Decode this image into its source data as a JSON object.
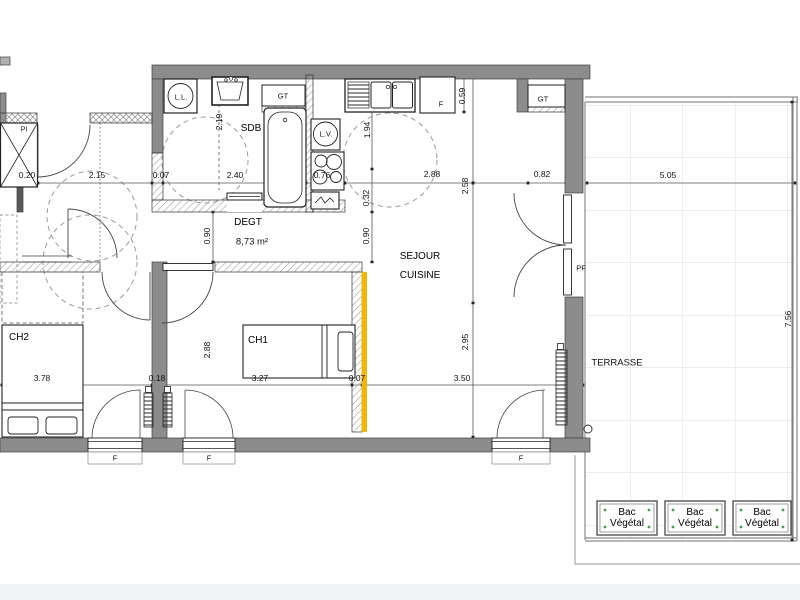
{
  "colors": {
    "wall_gray": "#8C8C8C",
    "highlight_wall": "#F2B705",
    "terrace_grid": "#DCDCDC",
    "planter_dot_green": "#3FA33F"
  },
  "rooms": {
    "sdb": "SDB",
    "degt": "DEGT",
    "degt_area": "8,73 m²",
    "sejour_line1": "SEJOUR",
    "sejour_line2": "CUISINE",
    "ch1": "CH1",
    "ch2": "CH2",
    "terrasse": "TERRASSE"
  },
  "fixtures": {
    "washing_machine": "L.L.",
    "dishwasher": "L.V.",
    "duct_bath": "GT",
    "duct_kitchen": "GT",
    "fridge": "F",
    "closet": "PI",
    "french_window": "PF"
  },
  "windows": {
    "f1": "F",
    "f2": "F",
    "f3": "F"
  },
  "planter": {
    "line1": "Bac",
    "line2": "Végétal"
  },
  "dimensions": {
    "top_chain": {
      "d1": "0.20",
      "d2": "2.15",
      "d3": "0.07",
      "d4": "2.40",
      "d5": "0.76",
      "d6": "2.88",
      "d7": "0.82"
    },
    "bottom_chain": {
      "d1": "3.78",
      "d2": "0.18",
      "d3": "3.27",
      "d4": "0.07",
      "d5": "3.50"
    },
    "vertical": {
      "sdb_height": "2.19",
      "kitchen_top": "1.94",
      "kitchen_mid": "0.32",
      "degt_left": "0.90",
      "degt_right": "0.90",
      "sejour_upper": "2.58",
      "sejour_lower": "2.95",
      "counter_depth": "0.59",
      "ch1_height": "2.88"
    },
    "terrace": {
      "width": "5.05",
      "depth": "7.56"
    }
  }
}
